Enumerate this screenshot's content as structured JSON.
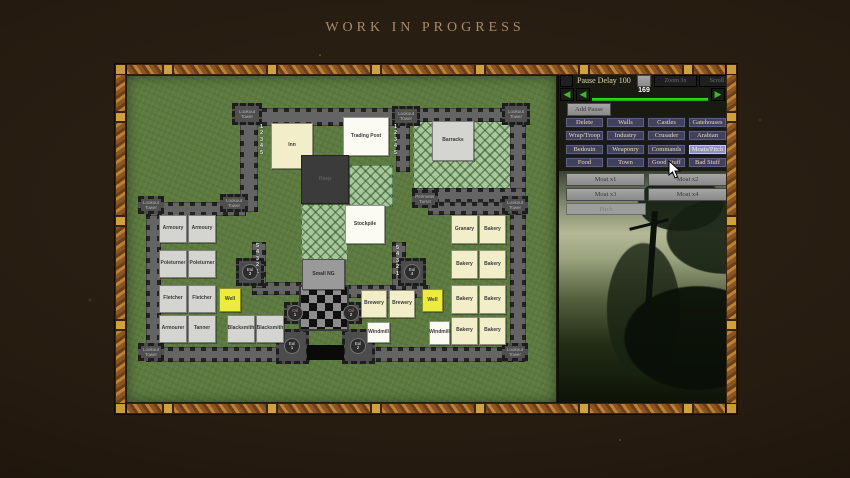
{
  "banner": "WORK IN PROGRESS",
  "panel": {
    "pause_delay_label": "Pause Delay 100",
    "zoom_button": "Zoom 3x",
    "scroll_button": "Scroll 2x",
    "frame_counter": "169",
    "add_pause_button": "Add Pause",
    "prev_arrow": "◀",
    "next_arrow": "▶",
    "category_buttons": [
      {
        "label": "Delete"
      },
      {
        "label": "Walls"
      },
      {
        "label": "Castles"
      },
      {
        "label": "Gatehouses"
      },
      {
        "label": "Wrap/Troop"
      },
      {
        "label": "Industry"
      },
      {
        "label": "Crusader"
      },
      {
        "label": "Arabian"
      },
      {
        "label": "Bedouin"
      },
      {
        "label": "Weaponry"
      },
      {
        "label": "Commands"
      },
      {
        "label": "Moats/Pitch"
      },
      {
        "label": "Food"
      },
      {
        "label": "Town"
      },
      {
        "label": "Good Stuff"
      },
      {
        "label": "Bad Stuff"
      }
    ],
    "moat_buttons": [
      {
        "label": "Moat x1"
      },
      {
        "label": "Moat x2"
      },
      {
        "label": "Moat x3"
      },
      {
        "label": "Moat x4"
      }
    ],
    "pitch_button": "Pitch",
    "colors": {
      "progress_green": "#2bd41c",
      "button_bg": "#41415e",
      "button_active_bg": "#8d8dcb"
    }
  },
  "map": {
    "keep": "Keep",
    "gatehouse": "Small NG",
    "stair_numbers_desc": "1\n2\n3\n4\n5",
    "stair_numbers_asc": "5\n4\n3\n2\n1",
    "towers": [
      {
        "label": "Lookout Tower"
      },
      {
        "label": "Lookout Tower"
      },
      {
        "label": "Lookout Tower"
      },
      {
        "label": "Lookout Tower"
      },
      {
        "label": "Perimeter Turret"
      },
      {
        "label": "Lookout Tower"
      },
      {
        "label": "Lookout Tower"
      },
      {
        "label": "Lookout Tower"
      },
      {
        "label": "Lookout Tower"
      }
    ],
    "buildings": [
      {
        "label": "Inn"
      },
      {
        "label": "Trading Post"
      },
      {
        "label": "Barracks"
      },
      {
        "label": "Stockpile"
      },
      {
        "label": "Granary"
      },
      {
        "label": "Bakery"
      },
      {
        "label": "Bakery"
      },
      {
        "label": "Bakery"
      },
      {
        "label": "Bakery"
      },
      {
        "label": "Bakery"
      },
      {
        "label": "Bakery"
      },
      {
        "label": "Bakery"
      },
      {
        "label": "Brewery"
      },
      {
        "label": "Brewery"
      },
      {
        "label": "Windmill"
      },
      {
        "label": "Windmill"
      },
      {
        "label": "Well"
      },
      {
        "label": "Well"
      },
      {
        "label": "Armoury"
      },
      {
        "label": "Armoury"
      },
      {
        "label": "Poleturner"
      },
      {
        "label": "Poleturner"
      },
      {
        "label": "Fletcher"
      },
      {
        "label": "Fletcher"
      },
      {
        "label": "Armourer"
      },
      {
        "label": "Tanner"
      },
      {
        "label": "Blacksmith"
      },
      {
        "label": "Blacksmith"
      }
    ],
    "markers": [
      {
        "abbr": "Oil",
        "num": "1"
      },
      {
        "abbr": "Oil",
        "num": "2"
      },
      {
        "abbr": "Bal",
        "num": "1"
      },
      {
        "abbr": "Bal",
        "num": "2"
      },
      {
        "abbr": "Bal",
        "num": "3"
      },
      {
        "abbr": "Bal",
        "num": "4"
      }
    ]
  }
}
